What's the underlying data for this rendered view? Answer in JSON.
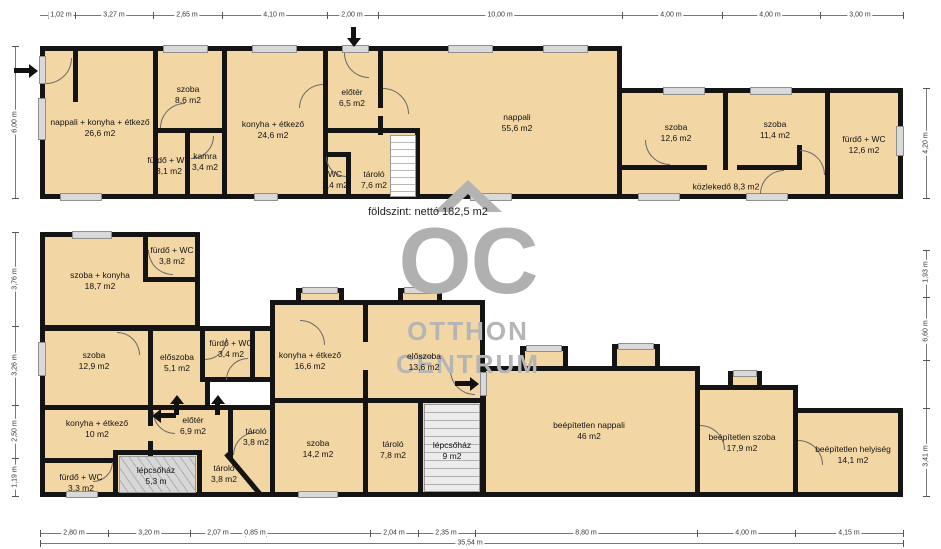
{
  "colors": {
    "room_fill": "#f2d6a4",
    "wall": "#141414",
    "window": "#d9d9d9",
    "watermark": "#b0b0b0",
    "dimension_text": "#333333"
  },
  "watermark": {
    "icon": "roof-chevron-icon",
    "line1": "OC",
    "line2": "OTTHON",
    "line3": "CENTRUM"
  },
  "ground_floor": {
    "summary": "földszint: nettó 182,5 m2",
    "rooms": [
      {
        "name": "nappali + konyha + étkező",
        "area": "26,6 m2"
      },
      {
        "name": "szoba",
        "area": "8,6 m2"
      },
      {
        "name": "fürdő + WC",
        "area": "3,1 m2"
      },
      {
        "name": "kamra",
        "area": "3,4 m2"
      },
      {
        "name": "konyha + étkező",
        "area": "24,6 m2"
      },
      {
        "name": "előtér",
        "area": "6,5 m2"
      },
      {
        "name": "WC",
        "area": "1,4 m2"
      },
      {
        "name": "tároló",
        "area": "7,6 m2"
      },
      {
        "name": "nappali",
        "area": "55,6 m2"
      },
      {
        "name": "szoba",
        "area": "12,6 m2"
      },
      {
        "name": "szoba",
        "area": "11,4 m2"
      },
      {
        "name": "fürdő + WC",
        "area": "12,6 m2"
      },
      {
        "name": "közlekedő",
        "area": "8,3 m2"
      }
    ]
  },
  "upper_floor": {
    "rooms": [
      {
        "name": "szoba + konyha",
        "area": "18,7 m2"
      },
      {
        "name": "fürdő + WC",
        "area": "3,8 m2"
      },
      {
        "name": "szoba",
        "area": "12,9 m2"
      },
      {
        "name": "előszoba",
        "area": "5,1 m2"
      },
      {
        "name": "fürdő + WC",
        "area": "3,4 m2"
      },
      {
        "name": "konyha + étkező",
        "area": "10 m2"
      },
      {
        "name": "előtér",
        "area": "6,9 m2"
      },
      {
        "name": "tároló",
        "area": "3,8 m2"
      },
      {
        "name": "tároló",
        "area": "3,8 m2"
      },
      {
        "name": "lépcsőház",
        "area": "5,3 m"
      },
      {
        "name": "fürdő + WC",
        "area": "3,3 m2"
      },
      {
        "name": "konyha + étkező",
        "area": "16,6 m2"
      },
      {
        "name": "előszoba",
        "area": "13,6 m2"
      },
      {
        "name": "szoba",
        "area": "14,2 m2"
      },
      {
        "name": "tároló",
        "area": "7,8 m2"
      },
      {
        "name": "lépcsőház",
        "area": "9 m2"
      },
      {
        "name": "beépítetlen nappali",
        "area": "46 m2"
      },
      {
        "name": "beépítetlen szoba",
        "area": "17,9 m2"
      },
      {
        "name": "beépítetlen helyiség",
        "area": "14,1 m2"
      }
    ]
  },
  "dimensions": {
    "top": [
      "1,02 m",
      "3,27 m",
      "2,65 m",
      "4,10 m",
      "2,00 m",
      "10,00 m",
      "4,00 m",
      "4,00 m",
      "3,00 m"
    ],
    "bottom": [
      "2,80 m",
      "3,20 m",
      "2,07 m",
      "0,85 m",
      "2,04 m",
      "2,35 m",
      "8,80 m",
      "4,00 m",
      "4,15 m"
    ],
    "total_width": "35,54 m",
    "left_ground": "6,00 m",
    "left_upper": [
      "3,76 m",
      "3,26 m",
      "2,50 m",
      "1,19 m"
    ],
    "right_ground": "4,20 m",
    "right_upper": [
      "1,93 m",
      "6,60 m",
      "3,41 m"
    ]
  }
}
